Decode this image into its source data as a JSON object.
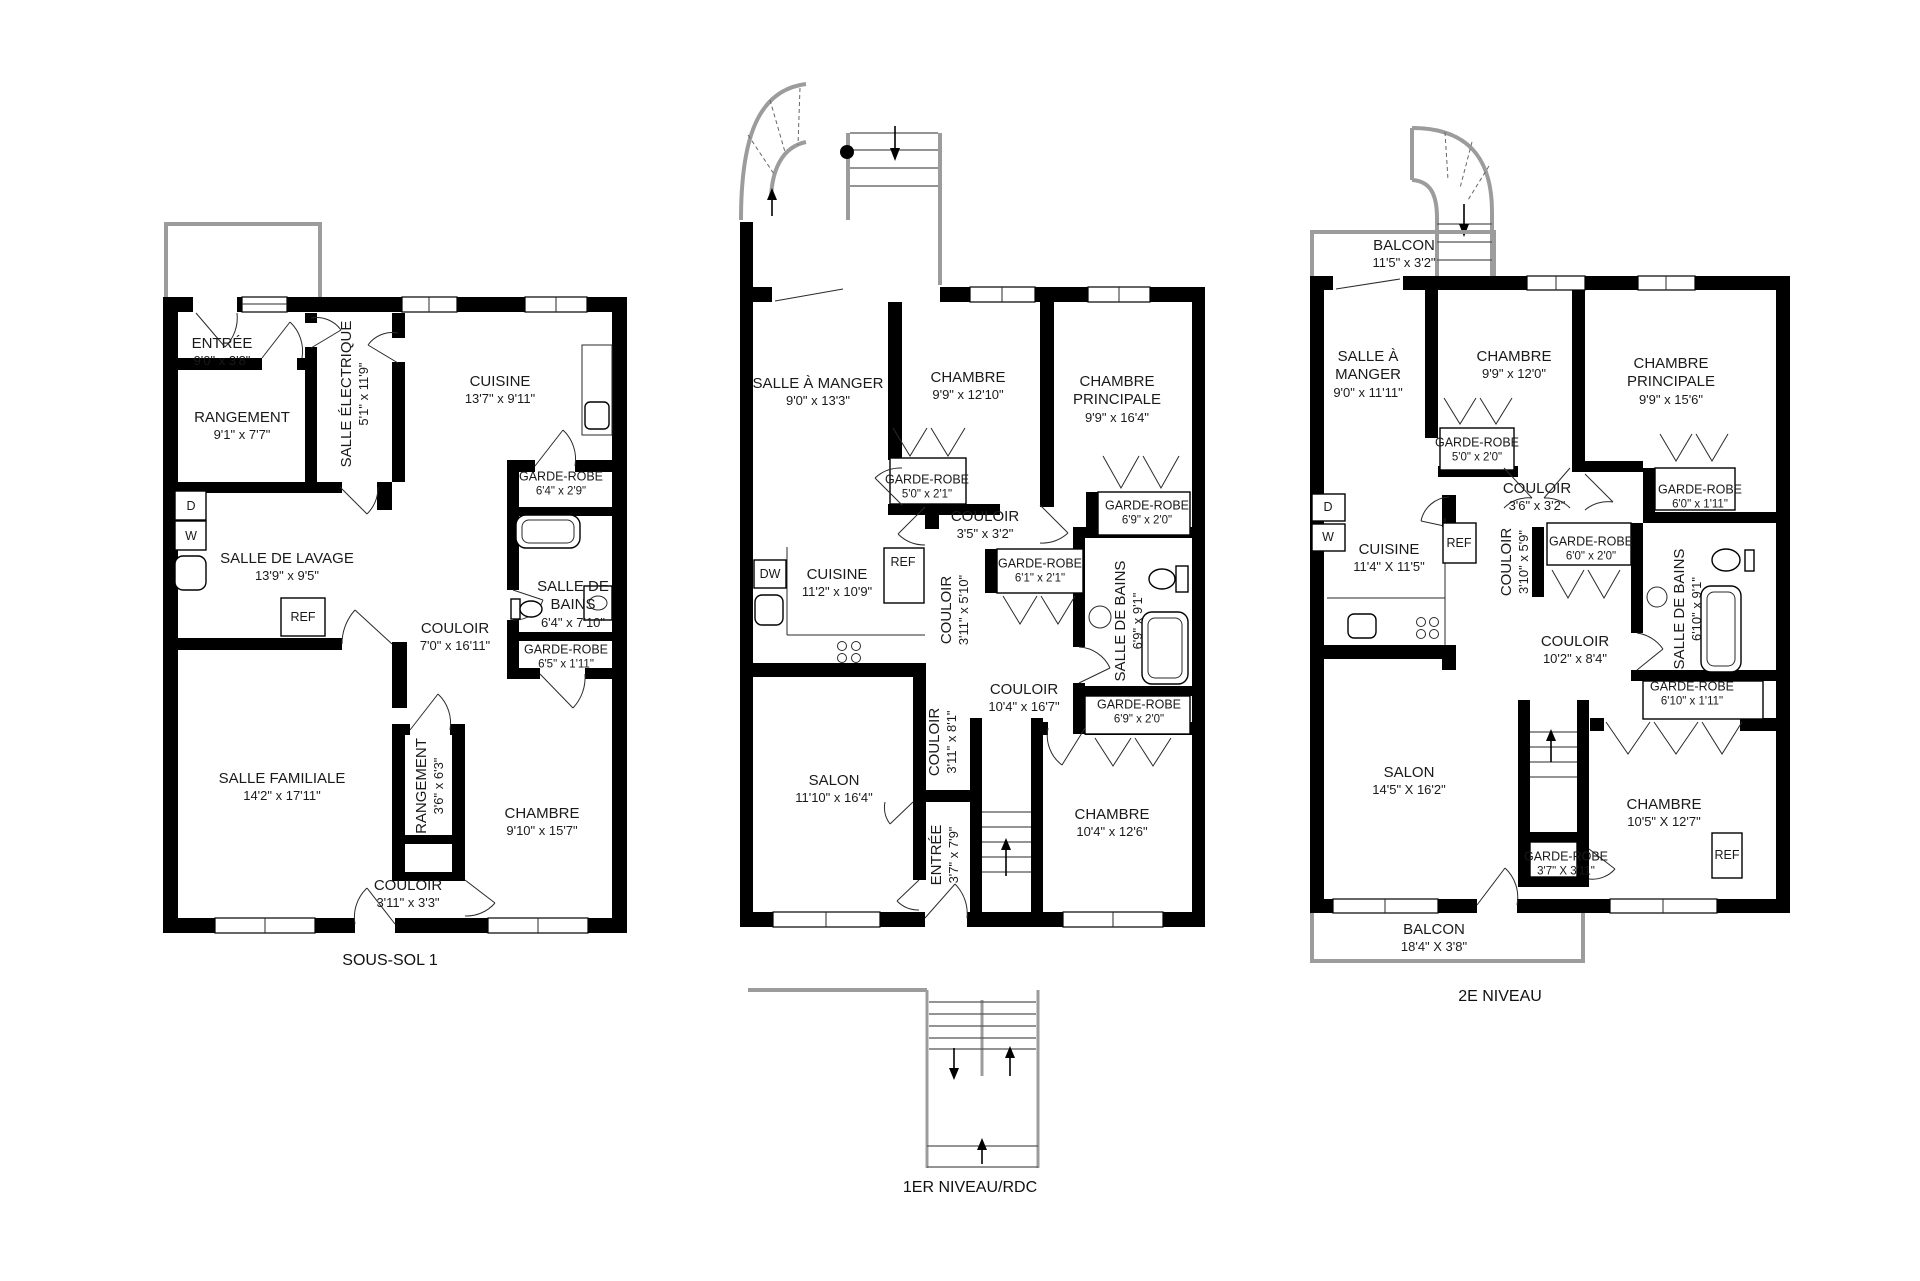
{
  "colors": {
    "walls": "#000000",
    "outdoor_gray": "#9c9c9c",
    "text": "#1a1a1a",
    "background": "#ffffff"
  },
  "plans": [
    {
      "title": "SOUS-SOL 1",
      "fixtures": {
        "dryer": "D",
        "washer": "W",
        "fridge": "REF"
      },
      "rooms": [
        {
          "name": "ENTRÉE",
          "dims": "9'0\" x 3'8\""
        },
        {
          "name": "RANGEMENT",
          "dims": "9'1\" x 7'7\""
        },
        {
          "name": "SALLE ÉLECTRIQUE",
          "dims": "5'1\" x 11'9\""
        },
        {
          "name": "CUISINE",
          "dims": "13'7\" x 9'11\""
        },
        {
          "name": "GARDE-ROBE",
          "dims": "6'4\" x 2'9\""
        },
        {
          "name": "SALLE DE LAVAGE",
          "dims": "13'9\" x 9'5\""
        },
        {
          "name": "SALLE DE BAINS",
          "dims": "6'4\" x 7'10\""
        },
        {
          "name": "COULOIR",
          "dims": "7'0\" x 16'11\""
        },
        {
          "name": "GARDE-ROBE",
          "dims": "6'5\" x 1'11\""
        },
        {
          "name": "SALLE FAMILIALE",
          "dims": "14'2\" x 17'11\""
        },
        {
          "name": "RANGEMENT",
          "dims": "3'6\" x 6'3\""
        },
        {
          "name": "CHAMBRE",
          "dims": "9'10\" x 15'7\""
        },
        {
          "name": "COULOIR",
          "dims": "3'11\" x 3'3\""
        }
      ]
    },
    {
      "title": "1ER NIVEAU/RDC",
      "fixtures": {
        "dishwasher": "DW",
        "fridge": "REF"
      },
      "rooms": [
        {
          "name": "SALLE À MANGER",
          "dims": "9'0\" x 13'3\""
        },
        {
          "name": "CHAMBRE",
          "dims": "9'9\" x 12'10\""
        },
        {
          "name": "CHAMBRE PRINCIPALE",
          "dims": "9'9\" x 16'4\""
        },
        {
          "name": "GARDE-ROBE",
          "dims": "5'0\" x 2'1\""
        },
        {
          "name": "COULOIR",
          "dims": "3'5\" x 3'2\""
        },
        {
          "name": "GARDE-ROBE",
          "dims": "6'9\" x 2'0\""
        },
        {
          "name": "GARDE-ROBE",
          "dims": "6'1\" x 2'1\""
        },
        {
          "name": "CUISINE",
          "dims": "11'2\" x 10'9\""
        },
        {
          "name": "COULOIR",
          "dims": "3'11\" x 5'10\""
        },
        {
          "name": "SALLE DE BAINS",
          "dims": "6'9\" x 9'1\""
        },
        {
          "name": "COULOIR",
          "dims": "10'4\" x 16'7\""
        },
        {
          "name": "GARDE-ROBE",
          "dims": "6'9\" x 2'0\""
        },
        {
          "name": "SALON",
          "dims": "11'10\" x 16'4\""
        },
        {
          "name": "COULOIR",
          "dims": "3'11\" x 8'1\""
        },
        {
          "name": "ENTRÉE",
          "dims": "3'7\" x 7'9\""
        },
        {
          "name": "CHAMBRE",
          "dims": "10'4\" x 12'6\""
        }
      ]
    },
    {
      "title": "2E NIVEAU",
      "fixtures": {
        "dryer": "D",
        "washer": "W",
        "fridge": "REF",
        "fridge2": "REF"
      },
      "rooms": [
        {
          "name": "BALCON",
          "dims": "11'5\" x 3'2\""
        },
        {
          "name": "SALLE À MANGER",
          "dims": "9'0\" x 11'11\""
        },
        {
          "name": "CHAMBRE",
          "dims": "9'9\" x 12'0\""
        },
        {
          "name": "CHAMBRE PRINCIPALE",
          "dims": "9'9\" x 15'6\""
        },
        {
          "name": "GARDE-ROBE",
          "dims": "5'0\" x 2'0\""
        },
        {
          "name": "COULOIR",
          "dims": "3'6\" x 3'2\""
        },
        {
          "name": "GARDE-ROBE",
          "dims": "6'0\" x 1'11\""
        },
        {
          "name": "GARDE-ROBE",
          "dims": "6'0\" x 2'0\""
        },
        {
          "name": "CUISINE",
          "dims": "11'4\" X 11'5\""
        },
        {
          "name": "COULOIR",
          "dims": "3'10\" x 5'9\""
        },
        {
          "name": "SALLE DE BAINS",
          "dims": "6'10\" x 9'1\""
        },
        {
          "name": "COULOIR",
          "dims": "10'2\" x 8'4\""
        },
        {
          "name": "GARDE-ROBE",
          "dims": "6'10\" x 1'11\""
        },
        {
          "name": "SALON",
          "dims": "14'5\" X 16'2\""
        },
        {
          "name": "CHAMBRE",
          "dims": "10'5\" X 12'7\""
        },
        {
          "name": "GARDE-ROBE",
          "dims": "3'7\" X 3'11\""
        },
        {
          "name": "BALCON",
          "dims": "18'4\" X 3'8\""
        }
      ]
    }
  ]
}
